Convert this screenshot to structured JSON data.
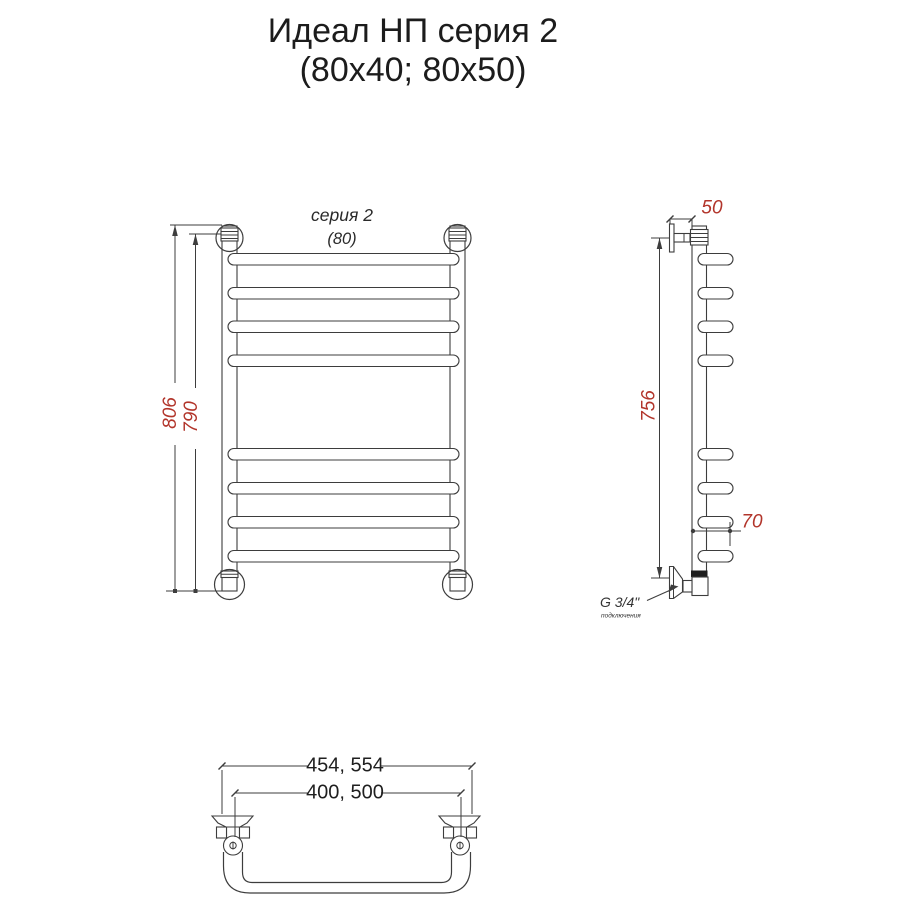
{
  "title": {
    "line1": "Идеал НП серия 2",
    "line2": "(80x40; 80x50)"
  },
  "front_view": {
    "series_label": "серия 2",
    "size_label": "(80)",
    "dim_height_outer": "806",
    "dim_height_inner": "790"
  },
  "side_view": {
    "dim_depth": "50",
    "dim_height": "756",
    "dim_hook": "70",
    "thread_label": "G 3/4\"",
    "thread_note": "подключения"
  },
  "bottom_view": {
    "dim_width_outer": "454, 554",
    "dim_width_inner": "400, 500"
  },
  "colors": {
    "dimension_red": "#b2352b",
    "line_dark": "#3d3d3d",
    "text_black": "#1c1c1c"
  }
}
